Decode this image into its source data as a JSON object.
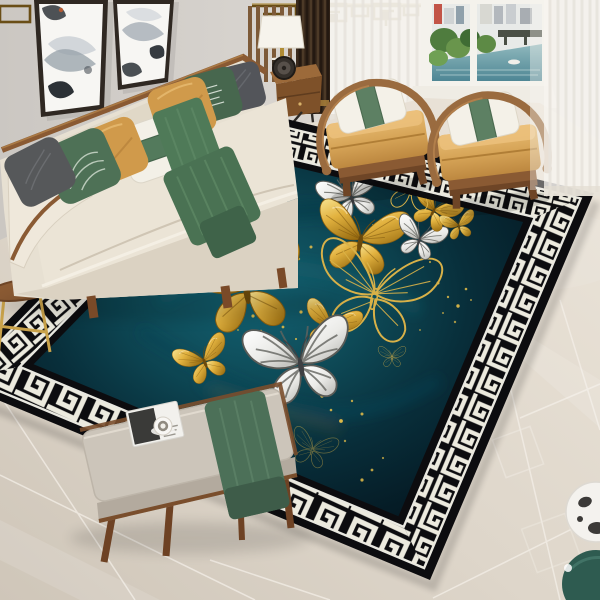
{
  "meta": {
    "title": "Living room with butterfly area rug",
    "description": "Product photo: dark teal rug with gold and white butterflies and Greek key border, cream sofa with pillows, two wooden armchairs, window with city view, bench with magazine, glossy marble floor"
  },
  "palette": {
    "wall": "#d8d4cf",
    "floor_light": "#eae3d8",
    "floor_dark": "#d2c9bc",
    "rug_black": "#0c0c0f",
    "rug_key_white": "#eceade",
    "rug_field_center": "#136070",
    "rug_field_edge": "#03121a",
    "gold": "#e2b23f",
    "gold_deep": "#a4731a",
    "butterfly_white": "#f2f2ef",
    "sofa_cream": "#e8e1d3",
    "wood": "#8a5a33",
    "green": "#4e7156",
    "mustard": "#d09a4b",
    "chair_cushion": "#d9a85f",
    "curtain_brown": "#3b2b1d",
    "sheer": "#f7f5f0"
  },
  "rug": {
    "sparkle_color": "#e8c049",
    "butterflies": [
      {
        "type": "white",
        "x": 352,
        "y": 199,
        "scale": 0.68,
        "rot": -18
      },
      {
        "type": "gold",
        "x": 360,
        "y": 243,
        "scale": 0.98,
        "rot": 10
      },
      {
        "type": "outline",
        "x": 374,
        "y": 299,
        "scale": 1.32,
        "rot": 12
      },
      {
        "type": "gold",
        "x": 247,
        "y": 293,
        "scale": 1.25,
        "rot": -8
      },
      {
        "type": "white",
        "x": 419,
        "y": 241,
        "scale": 0.55,
        "rot": 18
      },
      {
        "type": "gold",
        "x": 433,
        "y": 212,
        "scale": 0.55,
        "rot": 28
      },
      {
        "type": "outline",
        "x": 411,
        "y": 190,
        "scale": 0.66,
        "rot": 8
      },
      {
        "type": "gold",
        "x": 459,
        "y": 227,
        "scale": 0.38,
        "rot": -12,
        "opacity": 0.95
      },
      {
        "type": "gold",
        "x": 205,
        "y": 363,
        "scale": 0.6,
        "rot": -22
      },
      {
        "type": "gold",
        "x": 330,
        "y": 328,
        "scale": 0.62,
        "rot": 16
      },
      {
        "type": "white",
        "x": 301,
        "y": 367,
        "scale": 1.15,
        "rot": -10
      },
      {
        "type": "outline",
        "x": 392,
        "y": 358,
        "scale": 0.3,
        "rot": 0,
        "opacity": 0.8
      },
      {
        "type": "outline",
        "x": 265,
        "y": 222,
        "scale": 0.3,
        "rot": -10,
        "opacity": 0.7
      },
      {
        "type": "outline",
        "x": 312,
        "y": 451,
        "scale": 0.5,
        "rot": 18,
        "opacity": 0.45
      }
    ],
    "sparkles": [
      [
        253,
        316,
        1.6,
        0.9
      ],
      [
        261,
        331,
        1.2,
        0.8
      ],
      [
        272,
        342,
        1.8,
        0.95
      ],
      [
        247,
        302,
        1.1,
        0.7
      ],
      [
        283,
        327,
        1.4,
        0.85
      ],
      [
        296,
        339,
        1.1,
        0.8
      ],
      [
        301,
        312,
        1.6,
        0.9
      ],
      [
        311,
        352,
        1.3,
        0.75
      ],
      [
        322,
        396,
        1.7,
        0.9
      ],
      [
        331,
        410,
        1.3,
        0.85
      ],
      [
        341,
        421,
        1.9,
        0.95
      ],
      [
        352,
        401,
        1.2,
        0.8
      ],
      [
        362,
        414,
        1.5,
        0.85
      ],
      [
        299,
        259,
        1.2,
        0.7
      ],
      [
        311,
        247,
        1.5,
        0.85
      ],
      [
        287,
        251,
        1.0,
        0.6
      ],
      [
        438,
        283,
        1.5,
        0.9
      ],
      [
        448,
        297,
        1.2,
        0.8
      ],
      [
        458,
        306,
        1.7,
        0.9
      ],
      [
        443,
        313,
        1.0,
        0.7
      ],
      [
        466,
        289,
        1.3,
        0.85
      ],
      [
        471,
        300,
        1.0,
        0.7
      ],
      [
        392,
        229,
        1.2,
        0.75
      ],
      [
        403,
        222,
        1.4,
        0.8
      ],
      [
        373,
        225,
        1.0,
        0.65
      ],
      [
        430,
        262,
        1.1,
        0.7
      ],
      [
        372,
        470,
        1.4,
        0.8
      ],
      [
        383,
        458,
        1.1,
        0.7
      ],
      [
        362,
        480,
        1.6,
        0.85
      ],
      [
        345,
        441,
        1.2,
        0.7
      ],
      [
        260,
        352,
        1.2,
        0.75
      ],
      [
        238,
        330,
        1.0,
        0.6
      ],
      [
        455,
        322,
        1.2,
        0.7
      ],
      [
        420,
        330,
        1.0,
        0.6
      ],
      [
        248,
        258,
        1.1,
        0.7
      ],
      [
        266,
        246,
        1.3,
        0.8
      ]
    ]
  },
  "furniture": {
    "sofa_pillows": [
      "dark-gray",
      "green-leaf-print",
      "mustard",
      "white-green-band",
      "mustard",
      "green-script-print",
      "charcoal"
    ],
    "sofa_throw": "green runner draped over seat",
    "armchairs": 2,
    "armchair_pillow": "white with green band",
    "bench_items": [
      "magazine",
      "white cup",
      "green cloth"
    ]
  }
}
